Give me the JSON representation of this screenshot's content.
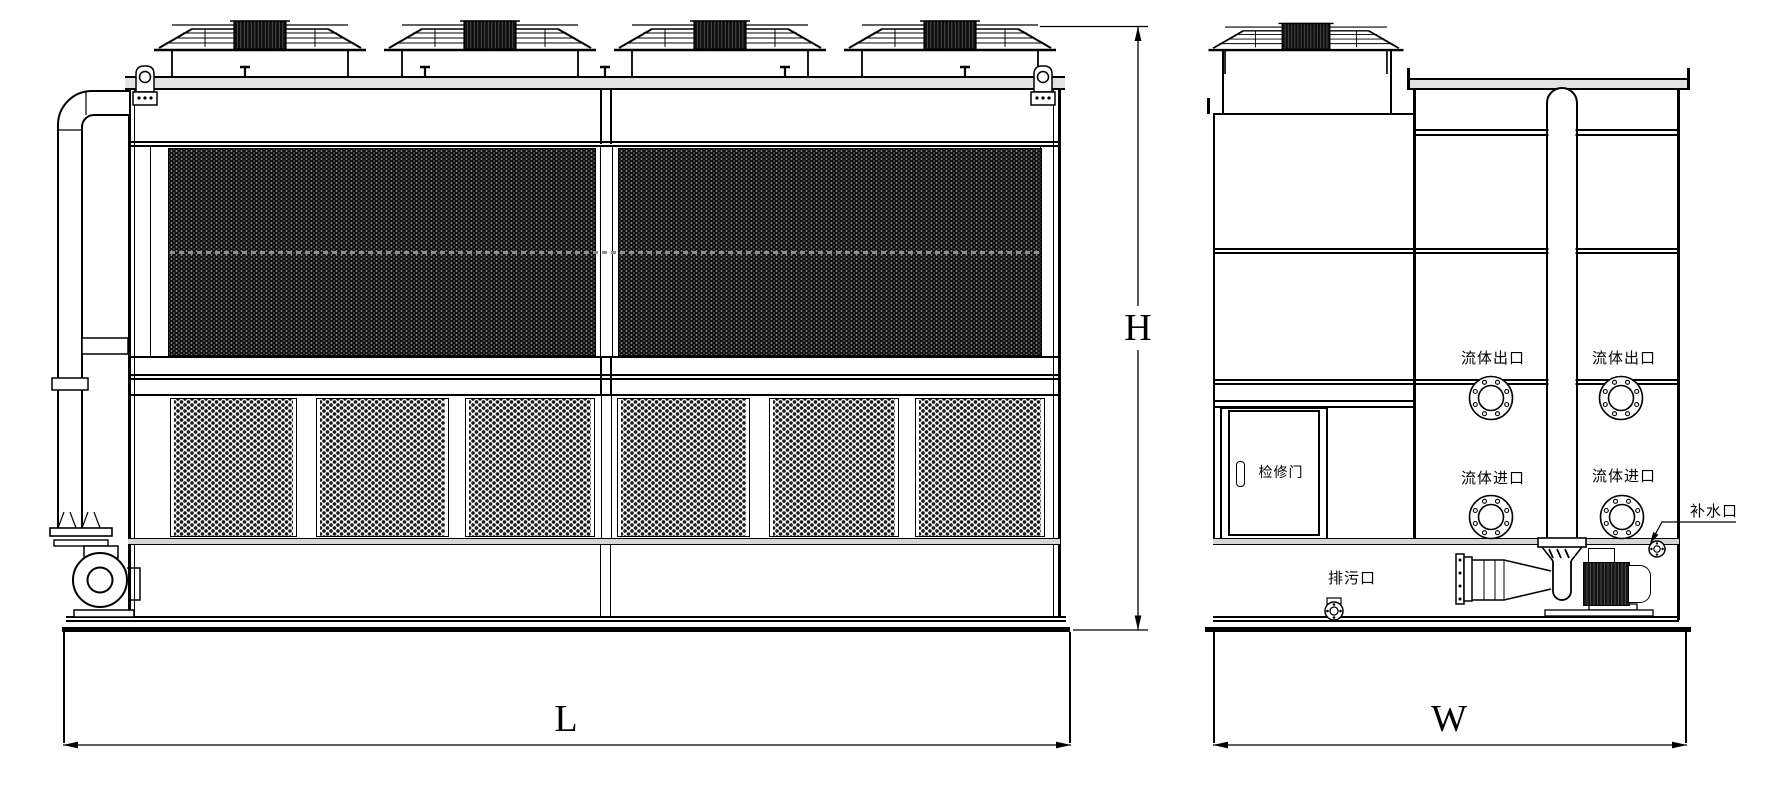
{
  "drawing_type": "cooling-tower-two-view-engineering-drawing",
  "dimension_labels": {
    "length": "L",
    "height": "H",
    "width": "W"
  },
  "labels": {
    "access_door": "检修门",
    "drain_port": "排污口",
    "makeup_water_port": "补水口",
    "fluid_outlet_left": "流体出口",
    "fluid_outlet_right": "流体出口",
    "fluid_inlet_left": "流体进口",
    "fluid_inlet_right": "流体进口"
  },
  "colors": {
    "line": "#000000",
    "background": "#ffffff",
    "coil_panel_dark": "#101010",
    "rail_gray": "#d6d6d6"
  }
}
